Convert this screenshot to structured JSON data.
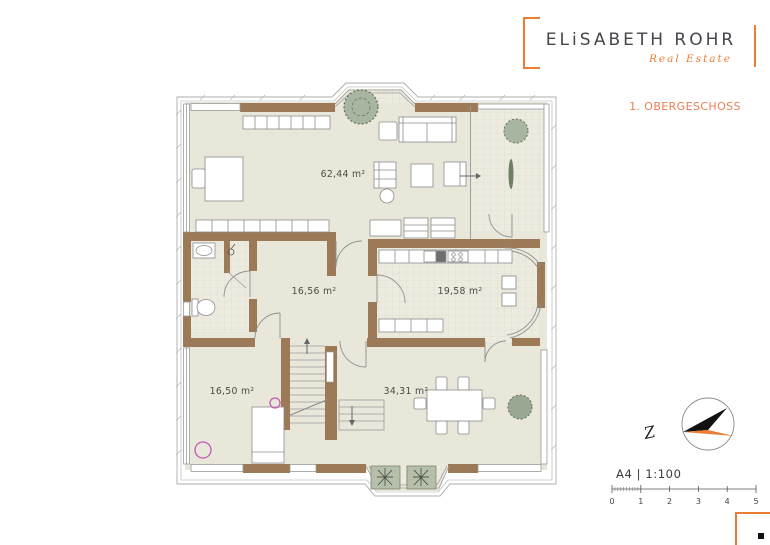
{
  "brand": {
    "name": "ELiSABETH ROHR",
    "tagline": "Real Estate"
  },
  "plan_title": "1. OBERGESCHOSS",
  "rooms": {
    "living": {
      "area_label": "62,44 m²"
    },
    "hall": {
      "area_label": "16,56 m²"
    },
    "kitchen": {
      "area_label": "19,58 m²"
    },
    "bedroom": {
      "area_label": "16,50 m²"
    },
    "dining": {
      "area_label": "34,31 m²"
    }
  },
  "compass": {
    "north_label": "Z"
  },
  "meta": {
    "format_and_scale": "A4 | 1:100"
  },
  "scale_bar": {
    "ticks": [
      "0",
      "1",
      "2",
      "3",
      "4",
      "5"
    ]
  },
  "colors": {
    "accent_orange": "#ED7D33",
    "title_orange": "#E97E52",
    "wall_brown": "#9C7A57",
    "floor_beige": "#E9E7DA",
    "tile_beige": "#EDEBDF",
    "plant_green": "#A8B5A0",
    "planter_green": "#B5BFA9",
    "highlight_magenta": "#C45AB5",
    "compass_black": "#111111"
  }
}
